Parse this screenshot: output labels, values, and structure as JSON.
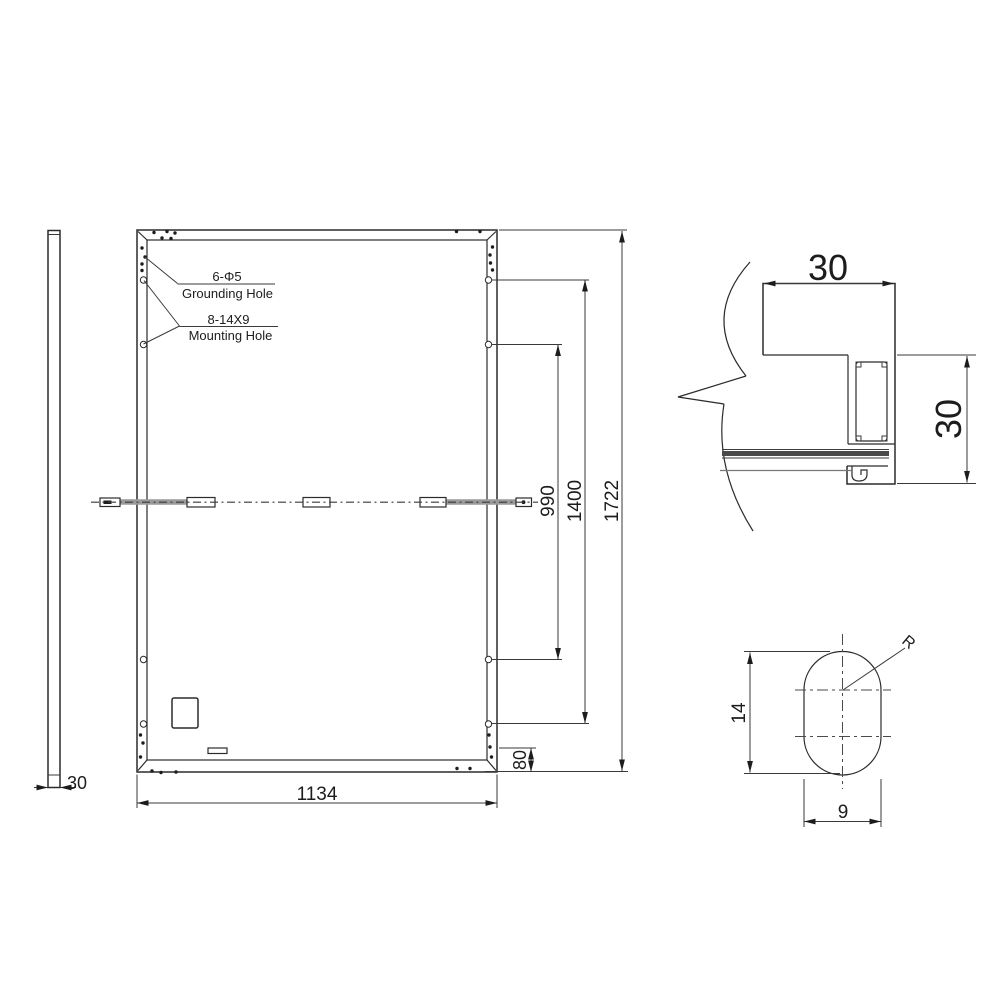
{
  "drawing_title": "Solar panel module dimensional drawing",
  "colors": {
    "line": "#2b2b2b",
    "background": "#ffffff"
  },
  "views": {
    "side_view": {
      "thickness_dim": "30"
    },
    "rear_view": {
      "grounding_spec": "6-Φ5",
      "grounding_label": "Grounding Hole",
      "mounting_spec": "8-14X9",
      "mounting_label": "Mounting Hole",
      "width_dim": "1134",
      "height_dim": "1722",
      "mounting_span_outer_dim": "1400",
      "mounting_span_inner_dim": "990",
      "bottom_offset_dim": "80"
    },
    "frame_section": {
      "flange_width_dim": "30",
      "frame_height_dim": "30"
    },
    "mounting_hole_detail": {
      "height_dim": "14",
      "width_dim": "9",
      "radius_label": "R"
    }
  }
}
